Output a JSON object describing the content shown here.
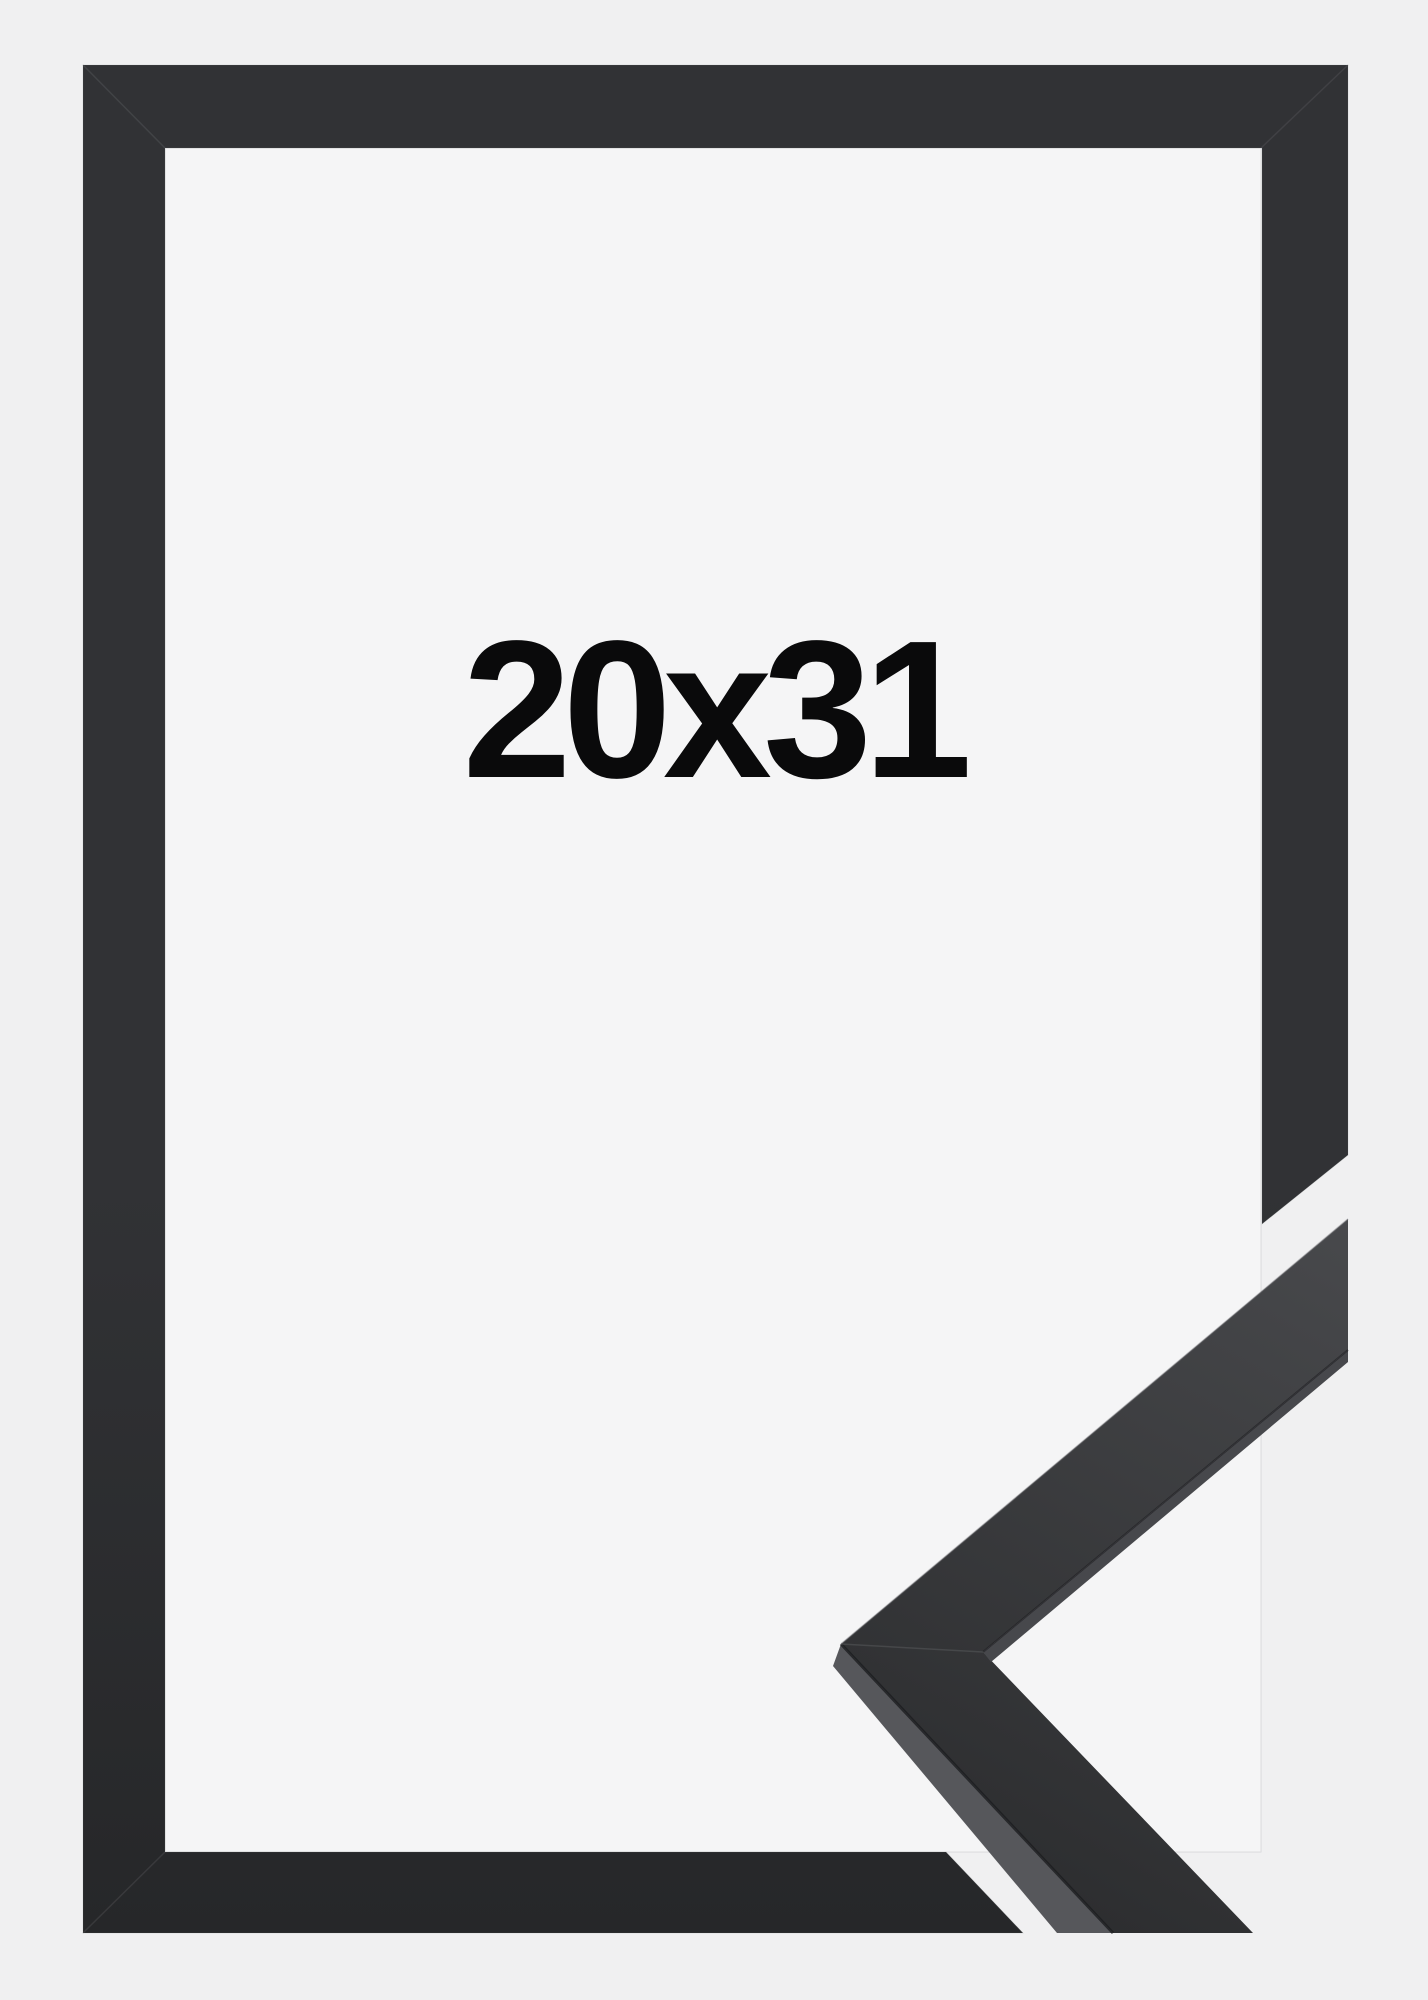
{
  "page": {
    "description": "Product photo of a black picture frame with a 3D corner-profile detail of the moulding at the lower right",
    "size_label": "20x31"
  },
  "theme": {
    "bg": "#f0f0f1",
    "interior": "#f5f5f6",
    "frame-top": "#313235",
    "frame-bottom": "#262729",
    "chev-light": "#48494c",
    "chev-dark": "#2a2b2d",
    "side-light": "#56575b",
    "side-mid": "#47484c",
    "seam": "#1c1d1f",
    "highlight": "#75767a",
    "label": "#0a0a0b"
  }
}
